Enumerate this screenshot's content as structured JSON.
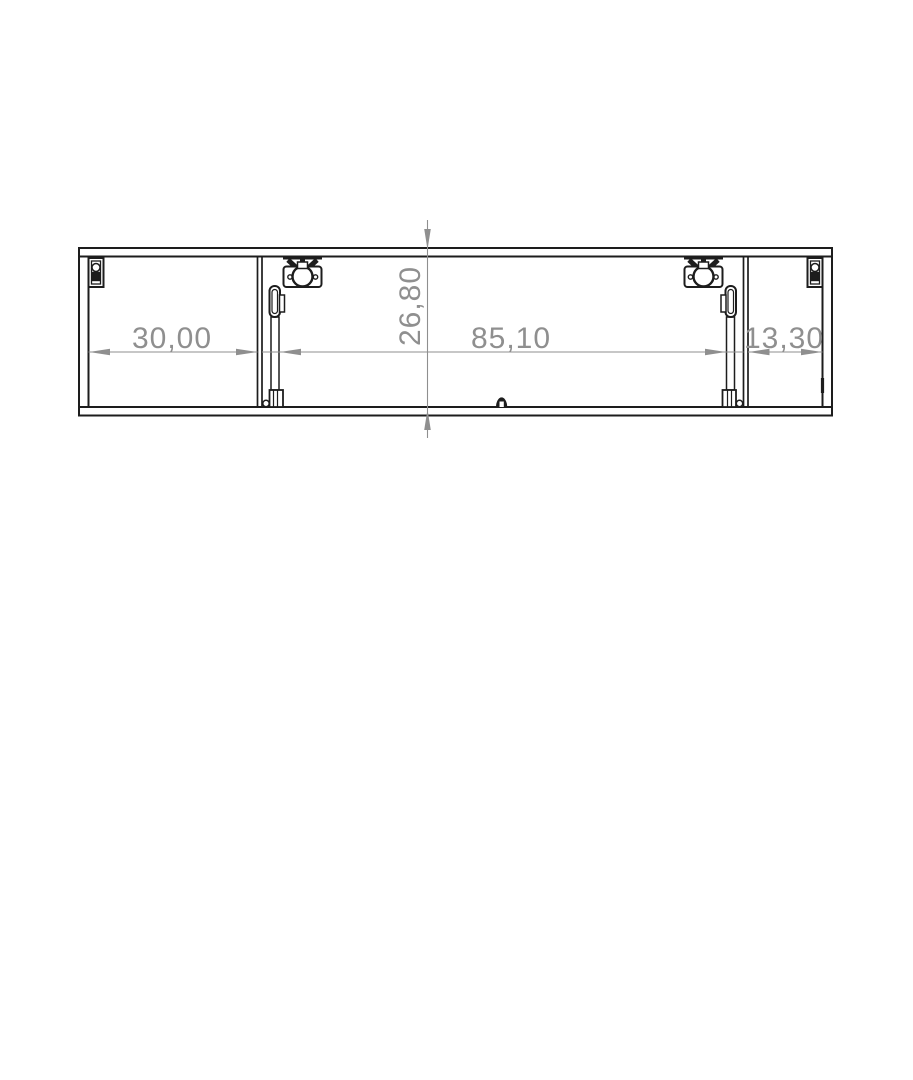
{
  "drawing": {
    "dimension_labels": {
      "left_compartment_width": "30,00",
      "middle_compartment_width": "85,10",
      "right_compartment_width": "13,30",
      "cabinet_depth": "26,80"
    },
    "colors": {
      "line": "#1d1d1d",
      "dimension": "#8f8f8f",
      "background": "#ffffff"
    }
  }
}
